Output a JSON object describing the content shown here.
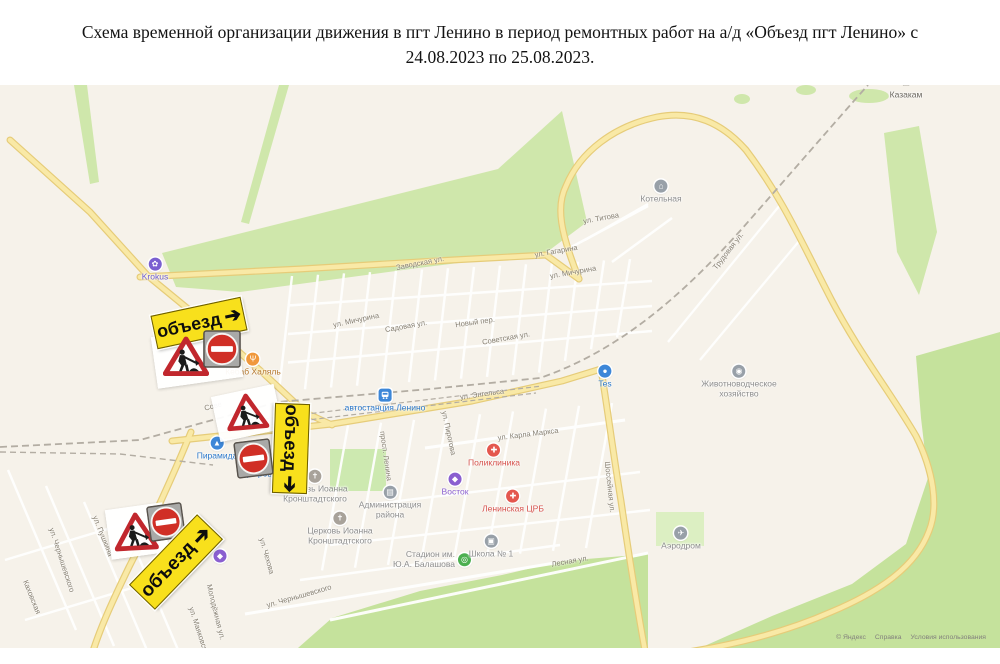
{
  "title": {
    "line1": "Схема временной организации движения в пгт Ленино в период ремонтных работ на а/д «Объезд пгт Ленино» с",
    "line2": "24.08.2023 по 25.08.2023."
  },
  "map": {
    "attribution": {
      "copyright": "© Яндекс",
      "help": "Справка",
      "terms": "Условия использования"
    },
    "detour_sign_text": "объезд",
    "detour_arrow": "➔",
    "colors": {
      "map_bg": "#f6f2ea",
      "green": "#cfe7ab",
      "green_dark": "#c5e29c",
      "green_light": "#dcefc2",
      "road_fill": "#f9e9a6",
      "road_casing": "#e6cc79",
      "railway": "#b3ada3",
      "street_text": "#857e70",
      "detour_bg": "#f8e01c",
      "noentry_red": "#d02f26",
      "roadwork_red": "#c1272d",
      "plate_gray": "#a9a9a7"
    },
    "pois": [
      {
        "id": "krokus",
        "label": "Krokus",
        "x": 155,
        "y": 270,
        "bg": "#7a5fd0",
        "glyph": "✿",
        "text": "#6b5bd2",
        "shape": "circle"
      },
      {
        "id": "kebab-halal",
        "label": "Кебаб Халяль",
        "x": 253,
        "y": 365,
        "bg": "#f0983c",
        "glyph": "Ψ",
        "text": "#b5762a",
        "shape": "circle"
      },
      {
        "id": "kotelnaya",
        "label": "Котельная",
        "x": 661,
        "y": 192,
        "bg": "#98a0a8",
        "glyph": "⌂",
        "text": "#8d8d8d",
        "shape": "circle"
      },
      {
        "id": "kazakam-monument",
        "label": "Казакам",
        "x": 906,
        "y": 89,
        "bg": "#6d6a63",
        "glyph": "♜",
        "text": "#6b675f",
        "shape": "plain"
      },
      {
        "id": "avtostantsiya-lenino",
        "label": "автостанция Ленино",
        "x": 385,
        "y": 401,
        "bg": "#3d87d8",
        "glyph": "bus",
        "text": "#2a77c9",
        "shape": "square"
      },
      {
        "id": "piramida",
        "label": "Пирамида",
        "x": 217,
        "y": 449,
        "bg": "#3d87d8",
        "glyph": "▲",
        "text": "#2a77c9",
        "shape": "circle"
      },
      {
        "id": "dobrotsen",
        "label": "Доброцен",
        "x": 262,
        "y": 467,
        "bg": "#3d87d8",
        "glyph": "●",
        "text": "#2a77c9",
        "shape": "circle"
      },
      {
        "id": "church-ioanna-1",
        "label": "Церковь Иоанна|Кронштадтского",
        "x": 315,
        "y": 487,
        "bg": "#a8a29a",
        "glyph": "✝",
        "text": "#8d8d8d",
        "shape": "circle"
      },
      {
        "id": "church-ioanna-2",
        "label": "Церковь Иоанна|Кронштадтского",
        "x": 340,
        "y": 529,
        "bg": "#a8a29a",
        "glyph": "✝",
        "text": "#8d8d8d",
        "shape": "circle"
      },
      {
        "id": "administratsiya",
        "label": "Администрация|района",
        "x": 390,
        "y": 503,
        "bg": "#98a0a8",
        "glyph": "▤",
        "text": "#8d8d8d",
        "shape": "circle"
      },
      {
        "id": "poliklinika",
        "label": "Поликлиника",
        "x": 494,
        "y": 456,
        "bg": "#e4574e",
        "glyph": "✚",
        "text": "#d6514b",
        "shape": "circle"
      },
      {
        "id": "vostok",
        "label": "Восток",
        "x": 455,
        "y": 485,
        "bg": "#8a5fd0",
        "glyph": "◆",
        "text": "#8a5fd0",
        "shape": "circle"
      },
      {
        "id": "leninskaya-crb",
        "label": "Ленинская ЦРБ",
        "x": 513,
        "y": 502,
        "bg": "#e4574e",
        "glyph": "✚",
        "text": "#d6514b",
        "shape": "circle"
      },
      {
        "id": "tes",
        "label": "Tes",
        "x": 605,
        "y": 377,
        "bg": "#3d87d8",
        "glyph": "●",
        "text": "#2a77c9",
        "shape": "circle"
      },
      {
        "id": "zhivotnovodcheskoe",
        "label": "Животноводческое|хозяйство",
        "x": 739,
        "y": 382,
        "bg": "#98a0a8",
        "glyph": "◉",
        "text": "#8d8d8d",
        "shape": "circle"
      },
      {
        "id": "aerodrom",
        "label": "Аэродром",
        "x": 681,
        "y": 539,
        "bg": "#98a0a8",
        "glyph": "✈",
        "text": "#8d8d8d",
        "shape": "circle"
      },
      {
        "id": "stadion-balashova",
        "label": "Стадион им.|Ю.А. Балашова",
        "x": 432,
        "y": 560,
        "bg": "#4caf50",
        "glyph": "◎",
        "text": "#8d8d8d",
        "shape": "circle",
        "side": "left"
      },
      {
        "id": "shkola-1",
        "label": "Школа № 1",
        "x": 491,
        "y": 547,
        "bg": "#98a0a8",
        "glyph": "▣",
        "text": "#8d8d8d",
        "shape": "circle"
      },
      {
        "id": "poi-dot",
        "label": "",
        "x": 220,
        "y": 556,
        "bg": "#8a5fd0",
        "glyph": "◆",
        "text": "#8a5fd0",
        "shape": "circle"
      }
    ],
    "streets": [
      {
        "t": "Заводская ул.",
        "x": 420,
        "y": 263,
        "r": -11
      },
      {
        "t": "ул. Титова",
        "x": 601,
        "y": 218,
        "r": -10
      },
      {
        "t": "ул. Гагарина",
        "x": 556,
        "y": 251,
        "r": -10
      },
      {
        "t": "ул. Мичурина",
        "x": 573,
        "y": 272,
        "r": -10
      },
      {
        "t": "ул. Мичурина",
        "x": 356,
        "y": 320,
        "r": -12
      },
      {
        "t": "Садовая ул.",
        "x": 406,
        "y": 326,
        "r": -10
      },
      {
        "t": "Новый пер.",
        "x": 475,
        "y": 322,
        "r": -8
      },
      {
        "t": "Советская ул.",
        "x": 506,
        "y": 338,
        "r": -10
      },
      {
        "t": "Сове",
        "x": 213,
        "y": 406,
        "r": -14
      },
      {
        "t": "ул. Энгельса",
        "x": 482,
        "y": 394,
        "r": -8
      },
      {
        "t": "ул. Карла Маркса",
        "x": 528,
        "y": 434,
        "r": -7
      },
      {
        "t": "ул. Пирогова",
        "x": 449,
        "y": 433,
        "r": 78
      },
      {
        "t": "просп. Ленина",
        "x": 386,
        "y": 456,
        "r": 82
      },
      {
        "t": "Трудовая ул.",
        "x": 728,
        "y": 251,
        "r": -52
      },
      {
        "t": "Шоссейная ул.",
        "x": 610,
        "y": 487,
        "r": 84
      },
      {
        "t": "Лесная ул.",
        "x": 570,
        "y": 561,
        "r": -10
      },
      {
        "t": "ул. Чернышевского",
        "x": 299,
        "y": 596,
        "r": -16
      },
      {
        "t": "ул. Чернышевского",
        "x": 62,
        "y": 560,
        "r": 72
      },
      {
        "t": "Каховская",
        "x": 32,
        "y": 597,
        "r": 68
      },
      {
        "t": "ул. Пушкина",
        "x": 103,
        "y": 536,
        "r": 68
      },
      {
        "t": "ул. Фрунзе",
        "x": 173,
        "y": 585,
        "r": -47
      },
      {
        "t": "Молодёжная ул.",
        "x": 216,
        "y": 612,
        "r": 76
      },
      {
        "t": "ул. Маяковского",
        "x": 200,
        "y": 634,
        "r": 72
      },
      {
        "t": "ул. Чехова",
        "x": 267,
        "y": 556,
        "r": 74
      }
    ],
    "signs": [
      {
        "kind": "backdrop",
        "x": 197,
        "y": 357,
        "w": 86,
        "h": 52,
        "r": -8
      },
      {
        "kind": "detour",
        "x": 198,
        "y": 322,
        "w": 90,
        "h": 32,
        "r": -12
      },
      {
        "kind": "roadwork",
        "x": 186,
        "y": 357,
        "s": 46,
        "r": 0
      },
      {
        "kind": "noentry",
        "x": 222,
        "y": 349,
        "s": 38,
        "r": 0
      },
      {
        "kind": "backdrop",
        "x": 247,
        "y": 413,
        "w": 64,
        "h": 46,
        "r": -12
      },
      {
        "kind": "roadwork",
        "x": 247,
        "y": 412,
        "s": 42,
        "r": -5
      },
      {
        "kind": "detour",
        "x": 290,
        "y": 447,
        "w": 88,
        "h": 33,
        "r": 92
      },
      {
        "kind": "noentry",
        "x": 253,
        "y": 458,
        "s": 37,
        "r": -7
      },
      {
        "kind": "backdrop",
        "x": 137,
        "y": 531,
        "w": 58,
        "h": 50,
        "r": -8
      },
      {
        "kind": "roadwork",
        "x": 136,
        "y": 532,
        "s": 44,
        "r": -3
      },
      {
        "kind": "noentry",
        "x": 166,
        "y": 522,
        "s": 36,
        "r": -8
      },
      {
        "kind": "detour",
        "x": 175,
        "y": 561,
        "w": 96,
        "h": 34,
        "r": -46
      }
    ]
  }
}
